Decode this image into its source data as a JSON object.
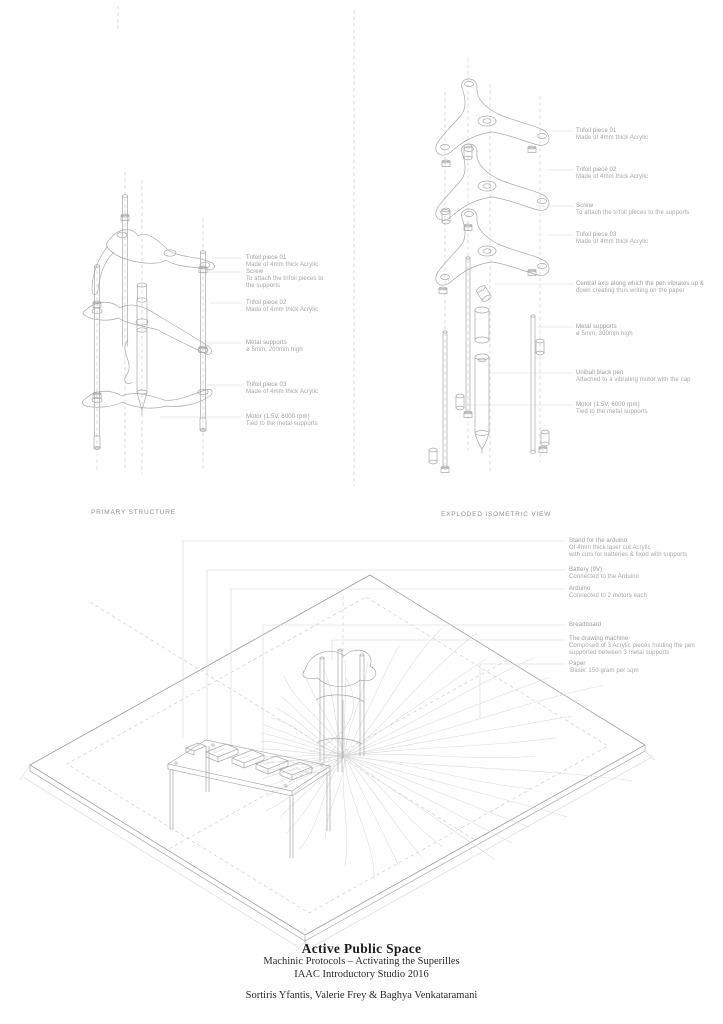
{
  "colors": {
    "ink": "#1c1c1c",
    "annotation": "#a6a6a6",
    "line": "#a9a9a9"
  },
  "primary": {
    "label": "PRIMARY STRUCTURE",
    "annotations": [
      {
        "title": "Trifoil piece 01",
        "line1": "Made of 4mm thick Acrylic"
      },
      {
        "title": "Screw",
        "line1": "To attach the trifoil pieces to",
        "line2": "the supports"
      },
      {
        "title": "Trifoil piece 02",
        "line1": "Made of 4mm thick Acrylic"
      },
      {
        "title": "Metal supports",
        "line1": "ø 5mm, 200mm high"
      },
      {
        "title": "Trifoil piece 03",
        "line1": "Made of 4mm thick Acrylic"
      },
      {
        "title": "Motor (1.5V, 6000 rpm)",
        "line1": "Tied to the metal supports"
      }
    ]
  },
  "exploded": {
    "label": "EXPLODED ISOMETRIC VIEW",
    "annotations": [
      {
        "title": "Trifoil piece 01",
        "line1": "Made of 4mm thick Acrylic"
      },
      {
        "title": "Trifoil piece 02",
        "line1": "Made of 4mm thick Acrylic"
      },
      {
        "title": "Screw",
        "line1": "To attach the trifoil pieces to the supports"
      },
      {
        "title": "Trifoil piece 03",
        "line1": "Made of 4mm thick Acrylic"
      },
      {
        "title": "Central axis along which the pen vibrates up &",
        "line1": "down creating thus writing on the paper"
      },
      {
        "title": "Metal supports",
        "line1": "ø 5mm, 300mm high"
      },
      {
        "title": "Uniball black pen",
        "line1": "Attached to a vibrating motor with the cap"
      },
      {
        "title": "Motor (1.5V, 6000 rpm)",
        "line1": "Tied to the metal supports"
      }
    ]
  },
  "assembly": {
    "annotations": [
      {
        "title": "Stand for the arduino",
        "line1": "Of 4mm thick laser cut Acrylic",
        "line2": "with cuts for batteries & fixed with supports"
      },
      {
        "title": "Battery (9V)",
        "line1": "Connected to the Arduino"
      },
      {
        "title": "Arduino",
        "line1": "Connected to 2 motors each"
      },
      {
        "title": "Breadboard"
      },
      {
        "title": "The drawing machine",
        "line1": "Composed of 3 Acrylic pieces holding the pen",
        "line2": "supported between 3 metal supports"
      },
      {
        "title": "Paper",
        "line1": "'Basik' 150 gram per sqm"
      }
    ]
  },
  "titleblock": {
    "title": "Active Public Space",
    "subtitle1": "Machinic Protocols – Activating the Superilles",
    "subtitle2": "IAAC Introductory Studio 2016",
    "authors": "Sortiris Yfantis, Valerie Frey & Baghya Venkataramani"
  }
}
